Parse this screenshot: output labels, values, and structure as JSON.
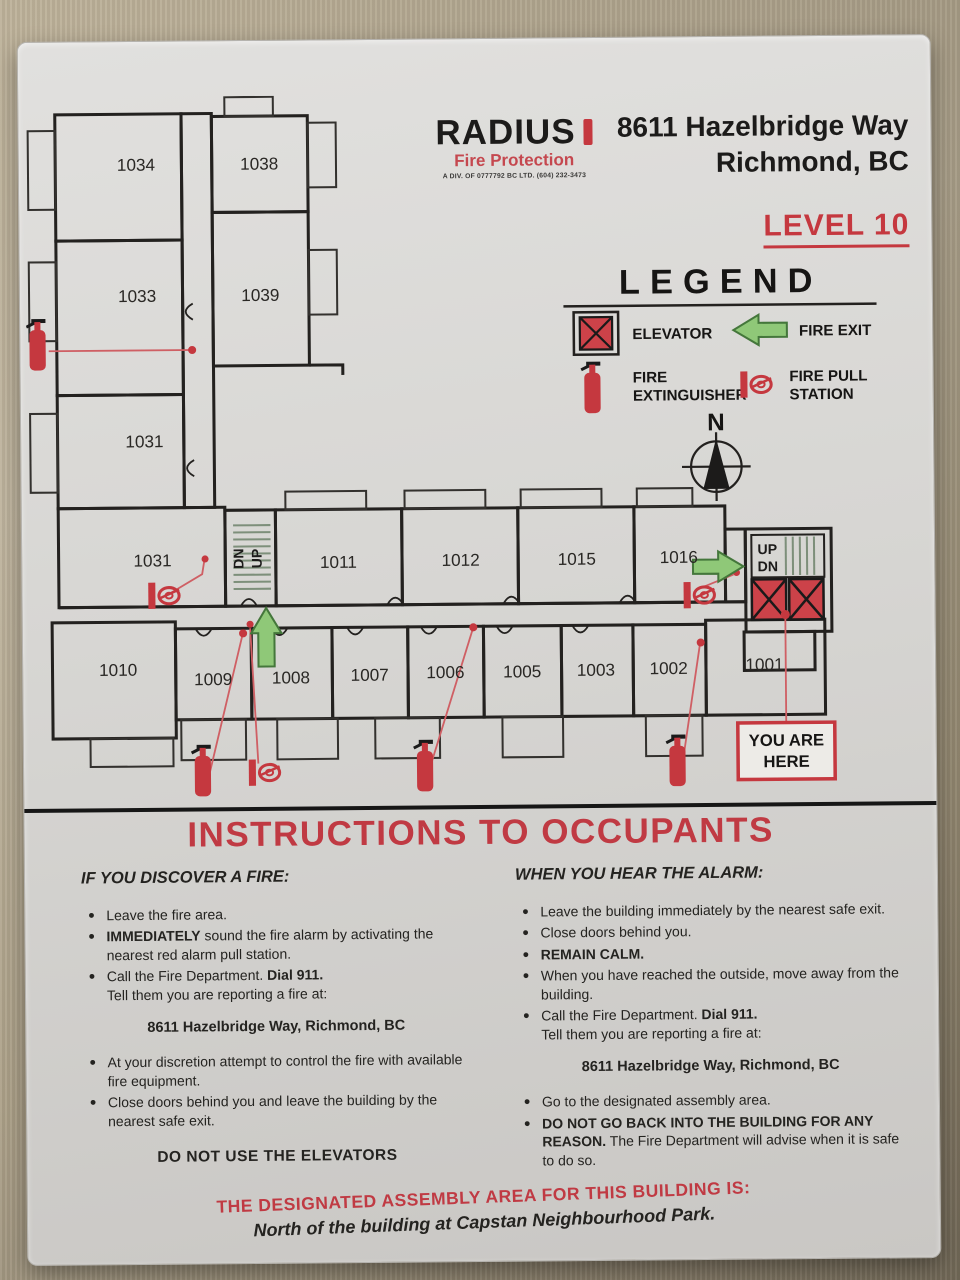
{
  "sign": {
    "logo": {
      "name": "RADIUS",
      "tagline": "Fire Protection",
      "subtext": "A DIV. OF 0777792 BC LTD.   (604) 232-3473"
    },
    "address_line1": "8611 Hazelbridge Way",
    "address_line2": "Richmond, BC",
    "level": "LEVEL 10"
  },
  "legend": {
    "title": "LEGEND",
    "elevator": "ELEVATOR",
    "fire_exit": "FIRE EXIT",
    "fire_ext_1": "FIRE",
    "fire_ext_2": "EXTINGUISHER",
    "pull_1": "FIRE PULL",
    "pull_2": "STATION"
  },
  "compass": {
    "north_label": "N"
  },
  "floor_plan": {
    "room_labels": [
      "1034",
      "1038",
      "1033",
      "1039",
      "1031",
      "1031",
      "1011",
      "1012",
      "1015",
      "1016",
      "1010",
      "1009",
      "1008",
      "1007",
      "1006",
      "1005",
      "1003",
      "1002",
      "1001"
    ],
    "stair1_line1": "DN",
    "stair1_line2": "UP",
    "stair2_line1": "UP",
    "stair2_line2": "DN",
    "you_are_here_line1": "YOU ARE",
    "you_are_here_line2": "HERE"
  },
  "instructions": {
    "heading": "INSTRUCTIONS TO OCCUPANTS",
    "left": {
      "title": "IF YOU DISCOVER A FIRE:",
      "bullet1": "Leave the fire area.",
      "bullet2_bold": "IMMEDIATELY",
      "bullet2_rest": " sound the fire alarm by activating the nearest red alarm pull station.",
      "bullet3_pre": "Call the Fire Department.  ",
      "bullet3_bold": "Dial 911.",
      "bullet3_line2": "Tell them you are reporting a fire at:",
      "address": "8611 Hazelbridge Way, Richmond, BC",
      "bullet4": "At your discretion attempt to control the fire with available fire equipment.",
      "bullet5": "Close doors behind you and leave the building by the nearest safe exit.",
      "footer": "DO NOT USE THE ELEVATORS"
    },
    "right": {
      "title": "WHEN YOU HEAR THE ALARM:",
      "bullet1": "Leave the building immediately by the nearest safe exit.",
      "bullet2": "Close doors behind you.",
      "bullet3_bold": "REMAIN CALM.",
      "bullet4": "When you have reached the outside, move away from the building.",
      "bullet5_pre": "Call the Fire Department.  ",
      "bullet5_bold": "Dial 911.",
      "bullet5_line2": "Tell them you are reporting a fire at:",
      "address": "8611 Hazelbridge Way, Richmond, BC",
      "bullet6": "Go to the designated assembly area.",
      "bullet7_bold": "DO NOT GO BACK INTO THE BUILDING FOR ANY REASON.",
      "bullet7_rest": "  The Fire Department will advise when it is safe to do so."
    }
  },
  "assembly": {
    "line1": "THE DESIGNATED ASSEMBLY AREA FOR THIS BUILDING IS:",
    "line2": "North of the building at Capstan Neighbourhood Park."
  },
  "colors": {
    "accent_red": "#c5383f",
    "exit_green": "#8fc878",
    "wall_line": "#23211f",
    "leader_red": "#cf5f64"
  }
}
